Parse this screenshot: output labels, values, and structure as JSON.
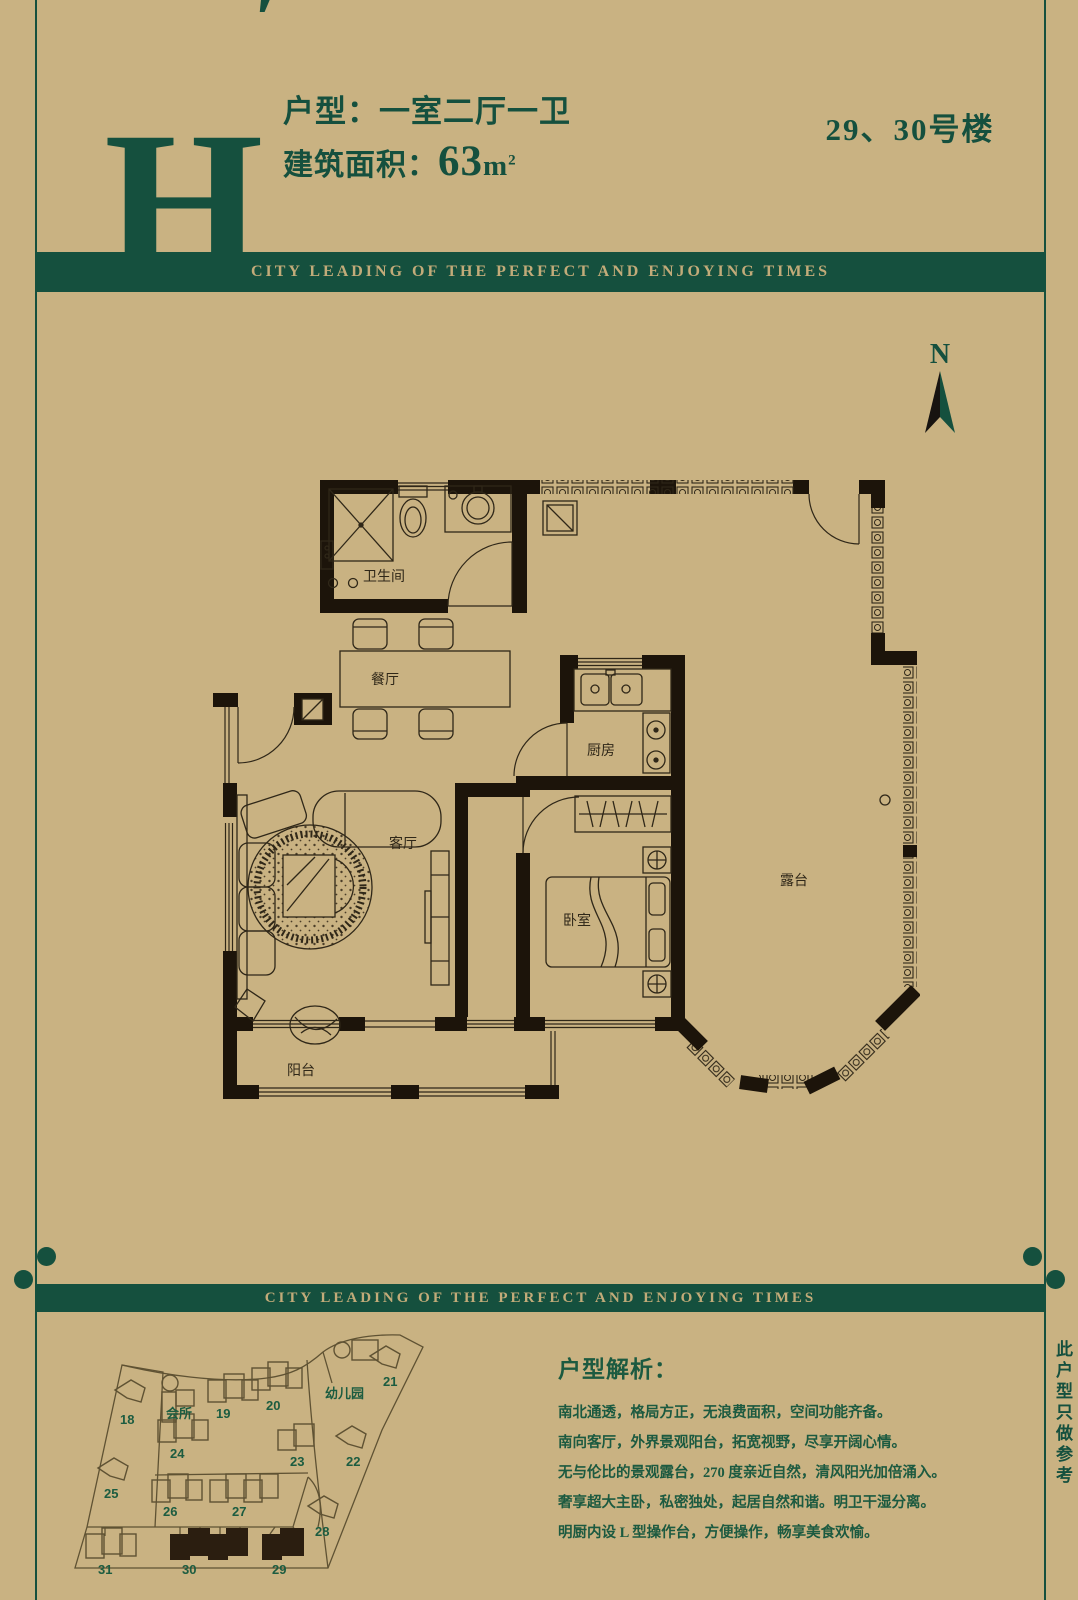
{
  "page": {
    "background_color": "#c9b282",
    "accent_green": "#15503e",
    "wall_color": "#1c140a",
    "banner_text_color": "#c2ab79"
  },
  "header": {
    "unit_letter": "H",
    "unit_letter_prime": "′",
    "unit_type": "户型：一室二厅一卫",
    "area_label": "建筑面积：",
    "area_value": "63",
    "area_unit_m": "m",
    "area_unit_sup": "2",
    "building_label": "29、30号楼"
  },
  "banner": {
    "text": "CITY LEADING OF THE PERFECT AND ENJOYING TIMES"
  },
  "compass": {
    "label": "N"
  },
  "floor_plan": {
    "labels": {
      "bathroom": "卫生间",
      "dining": "餐厅",
      "kitchen": "厨房",
      "living": "客厅",
      "bedroom": "卧室",
      "terrace": "露台",
      "balcony": "阳台"
    }
  },
  "site_plan": {
    "clubhouse": "会所",
    "kindergarten": "幼儿园",
    "numbers": [
      "18",
      "19",
      "20",
      "21",
      "22",
      "23",
      "24",
      "25",
      "26",
      "27",
      "28",
      "29",
      "30",
      "31"
    ],
    "highlighted": [
      "29",
      "30"
    ],
    "highlight_color": "#2b1e10"
  },
  "analysis": {
    "heading": "户型解析：",
    "lines": [
      "南北通透，格局方正，无浪费面积，空间功能齐备。",
      "南向客厅，外界景观阳台，拓宽视野，尽享开阔心情。",
      "无与伦比的景观露台，270 度亲近自然，清风阳光加倍涌入。",
      "奢享超大主卧，私密独处，起居自然和谐。明卫干湿分离。",
      "明厨内设 L 型操作台，方便操作，畅享美食欢愉。"
    ]
  },
  "side_note": "此户型只做参考"
}
